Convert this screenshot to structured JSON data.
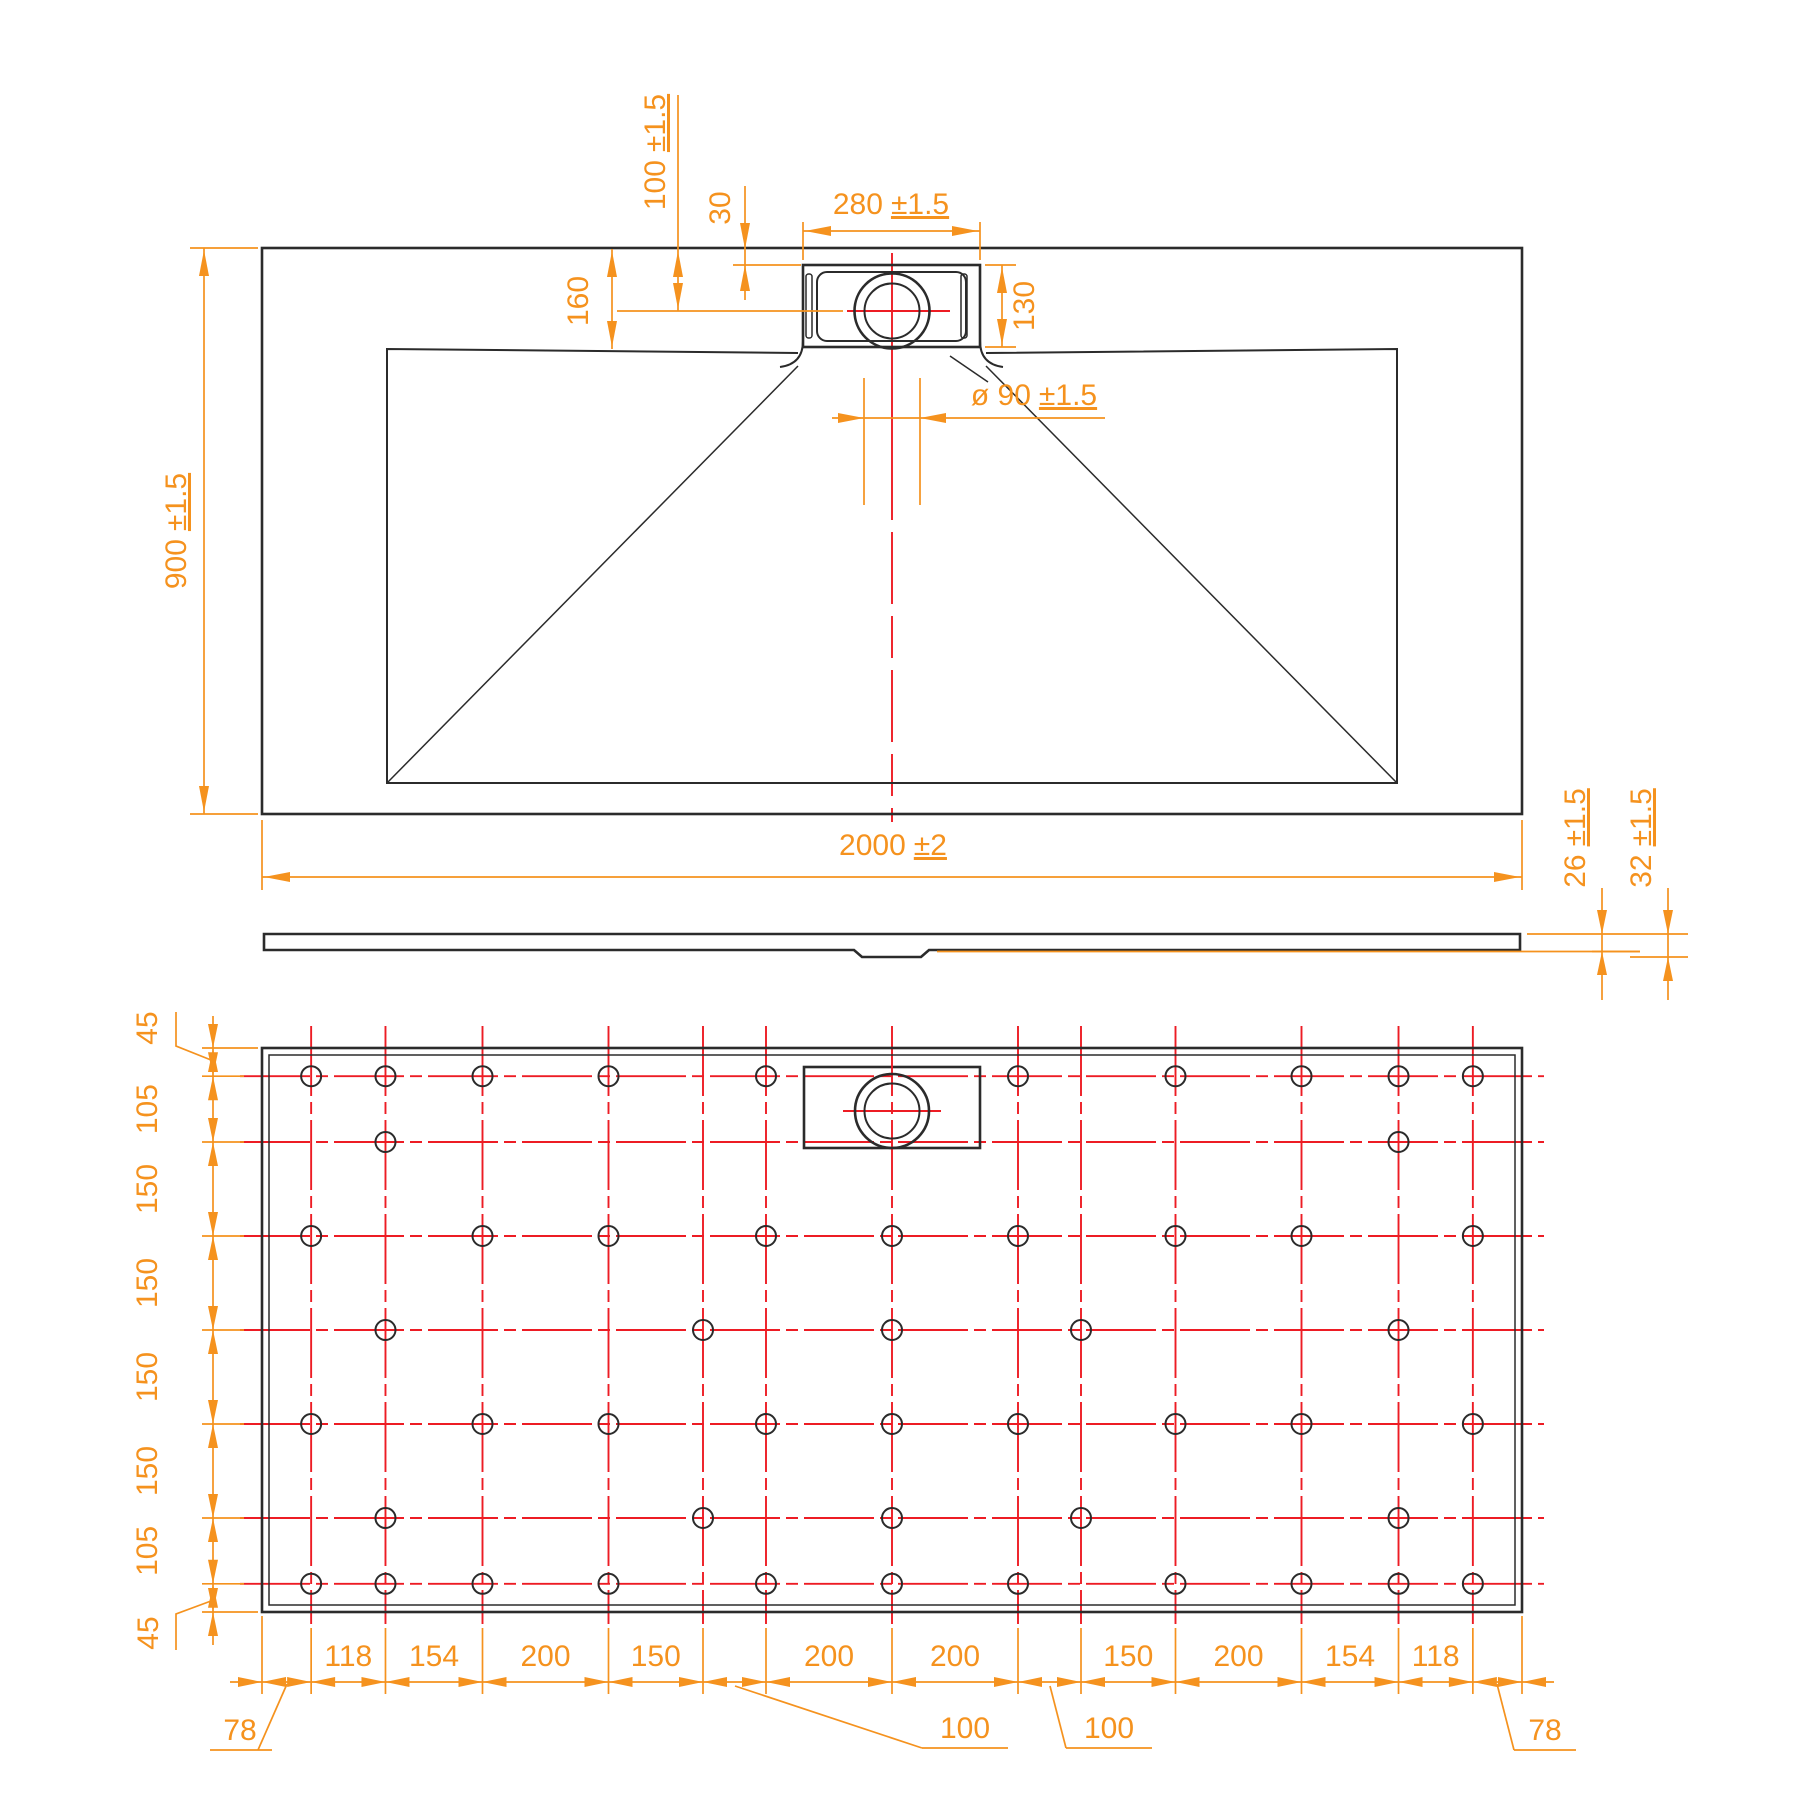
{
  "page": {
    "background": "#ffffff"
  },
  "colors": {
    "outline": "#2b2b2b",
    "dimension_accent": "#F5921E",
    "centerline_red": "#ED1C24"
  },
  "drawing": {
    "dimensions": {
      "tray_width": {
        "value": "2000",
        "tol": "±2"
      },
      "tray_depth": {
        "value": "900",
        "tol": "±1.5"
      },
      "drain_center_offset": {
        "value": "100",
        "tol": "±1.5"
      },
      "recess_top_offset": {
        "value": "30",
        "tol": ""
      },
      "recess_width": {
        "value": "280",
        "tol": "±1.5"
      },
      "basin_top_offset": {
        "value": "160",
        "tol": ""
      },
      "recess_depth": {
        "value": "130",
        "tol": ""
      },
      "drain_diameter": {
        "value": "ø 90",
        "tol": "±1.5"
      },
      "edge_thickness": {
        "value": "26",
        "tol": "±1.5"
      },
      "total_thickness": {
        "value": "32",
        "tol": "±1.5"
      }
    },
    "underside": {
      "row_chain": [
        "45",
        "105",
        "150",
        "150",
        "150",
        "150",
        "105",
        "45"
      ],
      "column_chain": [
        "78",
        "118",
        "154",
        "200",
        "150",
        "100",
        "200",
        "200",
        "100",
        "150",
        "200",
        "154",
        "118",
        "78"
      ],
      "rows_mm": [
        45,
        150,
        300,
        450,
        600,
        750,
        855
      ],
      "columns_mm": [
        78,
        196,
        350,
        550,
        700,
        800,
        1000,
        1200,
        1300,
        1450,
        1650,
        1804,
        1922
      ],
      "holes_by_row": [
        [
          1,
          2,
          3,
          4,
          6,
          8,
          10,
          11,
          12,
          13
        ],
        [
          2,
          12
        ],
        [
          1,
          3,
          4,
          6,
          7,
          8,
          10,
          11,
          13
        ],
        [
          2,
          5,
          7,
          9,
          12
        ],
        [
          1,
          3,
          4,
          6,
          7,
          8,
          10,
          11,
          13
        ],
        [
          2,
          5,
          7,
          9,
          12
        ],
        [
          1,
          2,
          3,
          4,
          6,
          7,
          8,
          10,
          11,
          12,
          13
        ]
      ]
    }
  }
}
